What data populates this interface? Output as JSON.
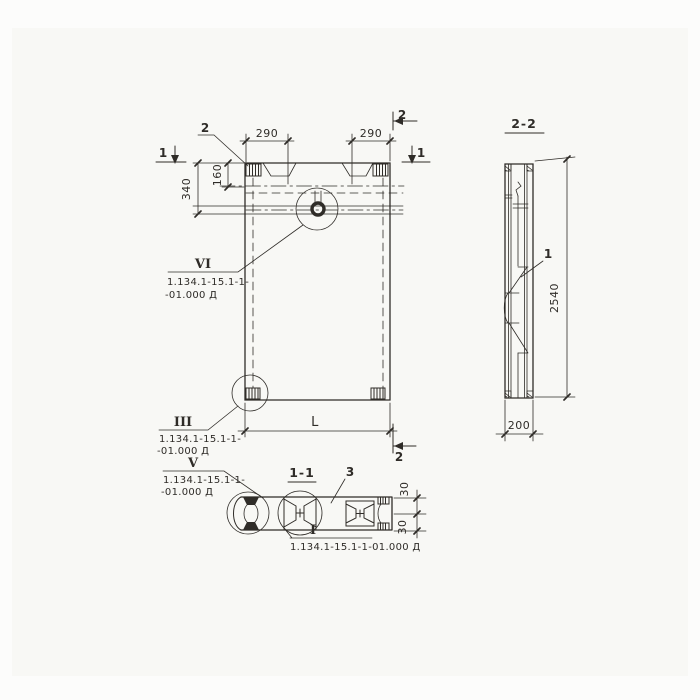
{
  "colors": {
    "ink": "#2f2c28",
    "paper": "#f8f8f5",
    "page": "#fcfcfb"
  },
  "front_view": {
    "section_marker_1_left": "1",
    "section_marker_1_right": "1",
    "section_marker_2_top": "2",
    "section_marker_2_bottom": "2",
    "detail_label_2": "2",
    "dim_290_left": "290",
    "dim_290_right": "290",
    "dim_340": "340",
    "dim_160": "160",
    "dim_length": "L",
    "callout_vi": {
      "numeral": "VI",
      "ref_line1": "1.134.1-15.1-1-",
      "ref_line2": "-01.000 Д"
    },
    "callout_iii": {
      "numeral": "III",
      "ref_line1": "1.134.1-15.1-1-",
      "ref_line2": "-01.000 Д"
    }
  },
  "section_1_1": {
    "title": "1-1",
    "detail_label_3": "3",
    "dim_30_top": "30",
    "dim_30_bottom": "30",
    "callout_v": {
      "numeral": "V",
      "ref_line1": "1.134.1-15.1-1-",
      "ref_line2": "-01.000 Д"
    },
    "callout_i": {
      "numeral": "I",
      "ref": "1.134.1-15.1-1-01.000 Д"
    }
  },
  "side_view": {
    "title": "2-2",
    "detail_label_1": "1",
    "dim_2540": "2540",
    "dim_200": "200"
  }
}
